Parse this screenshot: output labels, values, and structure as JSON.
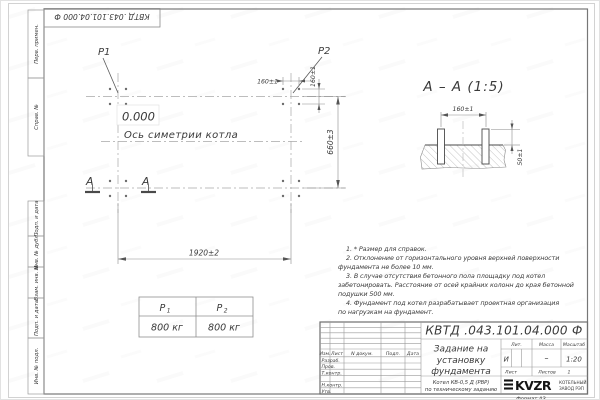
{
  "margins": {
    "top_stamp": "КВТД .043.101.04.000   Ф",
    "perv_primen": "Перв. примен.",
    "sprav_no": "Справ. №",
    "podp_i_data_upper": "Подп. и дата",
    "inv_no_dubl": "Инв. № дубл.",
    "vzam_inv_no": "Взам. инв. №",
    "podp_i_data_lower": "Подп. и дата",
    "inv_no_podl": "Инв. № подл."
  },
  "plan": {
    "load1_label": "P1",
    "load2_label": "P2",
    "level_mark": "0.000",
    "symmetry_axis_label": "Ось симетрии котла",
    "section_mark_left": "А",
    "section_mark_right": "А",
    "dim_length": "1920±2",
    "dim_width": "660±3",
    "dim_bolt_spacing_x": "160±1",
    "dim_bolt_spacing_y": "160±1"
  },
  "section_view": {
    "title": "А – А (1:5)",
    "dim_bolt_spacing": "160±1",
    "dim_bolt_height": "50±1"
  },
  "load_table": {
    "col1_base": "Р",
    "col1_sub": "1",
    "col2_base": "Р",
    "col2_sub": "2",
    "val1": "800 кг",
    "val2": "800 кг"
  },
  "notes": {
    "line1": "1. * Размер для справок.",
    "line2": "2. Отклонение от горизонтального уровня верхней поверхности",
    "line3": "фундамента не более 10 мм.",
    "line4": "3. В случае отсутствия бетонного пола площадку под котел",
    "line5": "забетонировать. Расстояние от осей крайних колонн до края бетонной",
    "line6": "подушки 500 мм.",
    "line7": "4. Фундамент под котел разрабатывает проектная организация",
    "line8": "по нагрузкам на фундамент."
  },
  "title_block": {
    "doc_number": "КВТД .043.101.04.000   Ф",
    "title_line1": "Задание на",
    "title_line2": "установку",
    "title_line3": "фундамента",
    "product_line1": "Котел  КВ-0,5  Д  (РВР)",
    "product_line2": "по техническому заданию",
    "col_izm": "Изм.",
    "col_list": "Лист",
    "col_doc": "N докум.",
    "col_podp": "Подп.",
    "col_data": "Дата",
    "row_razrab": "Разраб.",
    "row_prov": "Пров.",
    "row_tkontr": "Т.контр.",
    "row_nkontr": "Н.контр.",
    "row_utv": "Утв.",
    "lit_header": "Лит.",
    "mass_header": "Масса",
    "scale_header": "Масштаб",
    "lit_value": "И",
    "mass_value": "–",
    "scale_value": "1:20",
    "list_label": "Лист",
    "listov_label": "Листов",
    "listov_value": "1",
    "logo_text": "KVZR",
    "org_line1": "КОТЕЛЬНЫЙ",
    "org_line2": "ЗАВОД РЭП",
    "format_label": "Формат А3"
  }
}
